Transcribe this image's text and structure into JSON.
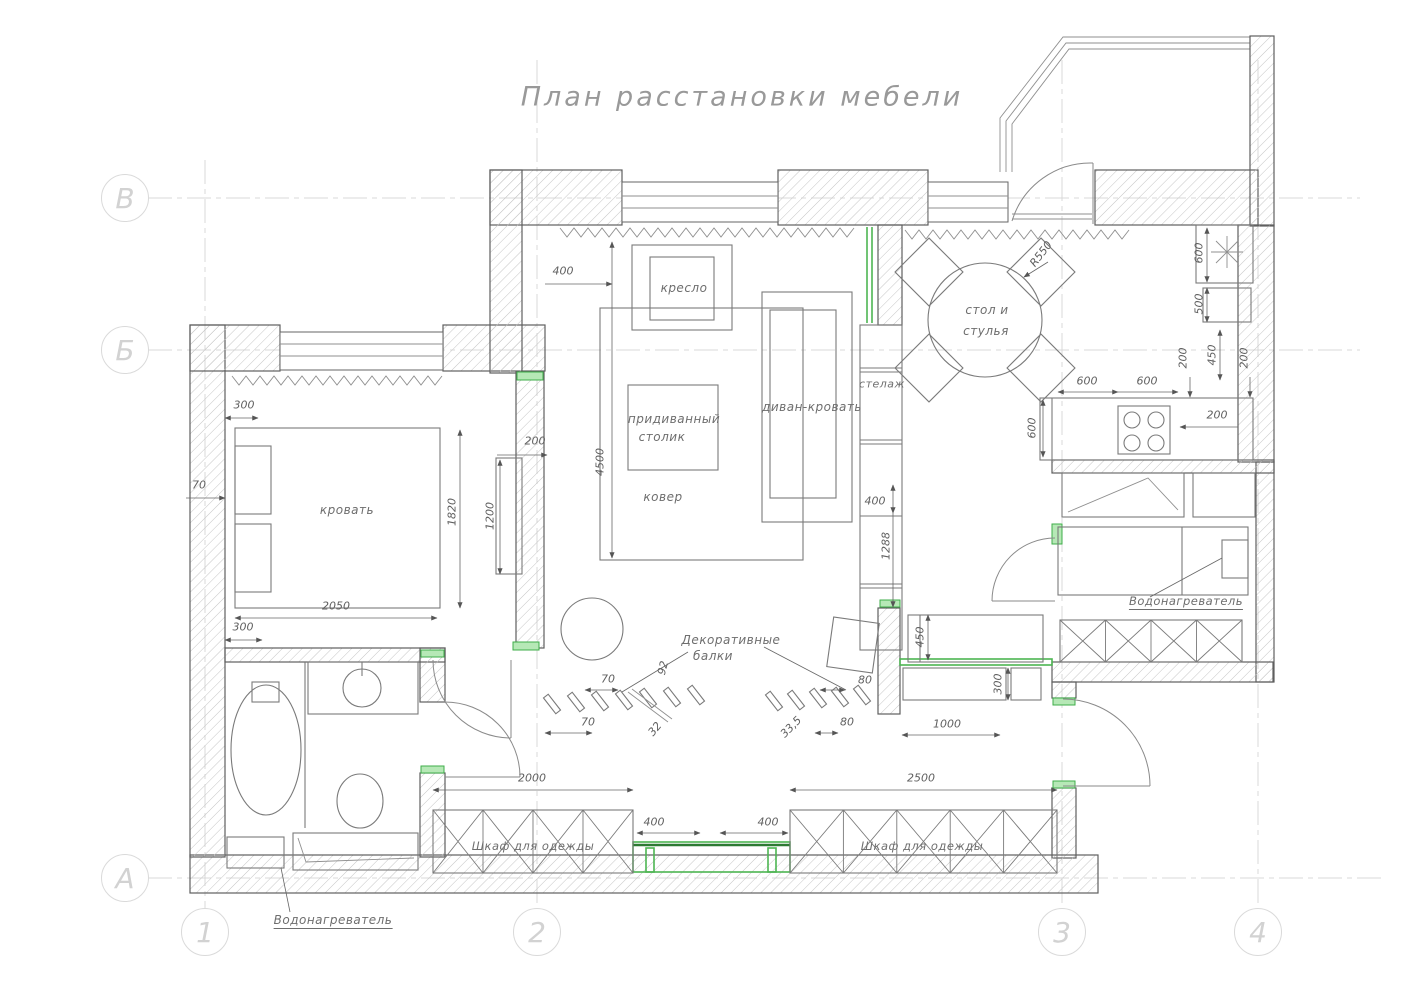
{
  "title": {
    "text": "План расстановки мебели"
  },
  "colors": {
    "accent_green": "#4db552",
    "line": "#6a6a6a",
    "grid": "#d9d9d9",
    "hatch": "#c6c6c6"
  },
  "grid": {
    "rows": [
      {
        "name": "grid-bubble-v",
        "label": "В",
        "x": 125,
        "y": 198
      },
      {
        "name": "grid-bubble-b",
        "label": "Б",
        "x": 125,
        "y": 350
      },
      {
        "name": "grid-bubble-a",
        "label": "А",
        "x": 125,
        "y": 878
      }
    ],
    "cols": [
      {
        "name": "grid-bubble-1",
        "label": "1",
        "x": 205,
        "y": 932
      },
      {
        "name": "grid-bubble-2",
        "label": "2",
        "x": 537,
        "y": 932
      },
      {
        "name": "grid-bubble-3",
        "label": "3",
        "x": 1062,
        "y": 932
      },
      {
        "name": "grid-bubble-4",
        "label": "4",
        "x": 1258,
        "y": 932
      }
    ]
  },
  "labels": [
    {
      "name": "armchair-label",
      "text": "кресло",
      "x": 684,
      "y": 288
    },
    {
      "name": "sidetable-label-line1",
      "text": "придиванный",
      "x": 674,
      "y": 419
    },
    {
      "name": "sidetable-label-line2",
      "text": "столик",
      "x": 662,
      "y": 437
    },
    {
      "name": "sofa-label",
      "text": "диван-кровать",
      "x": 812,
      "y": 407
    },
    {
      "name": "shelf-label",
      "text": "стелаж",
      "x": 882,
      "y": 384,
      "s": 11
    },
    {
      "name": "carpet-label",
      "text": "ковер",
      "x": 663,
      "y": 497
    },
    {
      "name": "dining-label-line1",
      "text": "стол и",
      "x": 987,
      "y": 310
    },
    {
      "name": "dining-label-line2",
      "text": "стулья",
      "x": 986,
      "y": 331
    },
    {
      "name": "bed-label",
      "text": "кровать",
      "x": 347,
      "y": 510
    },
    {
      "name": "wardrobe-left-label",
      "text": "Шкаф для одежды",
      "x": 533,
      "y": 846,
      "s": 11.5
    },
    {
      "name": "wardrobe-right-label",
      "text": "Шкаф для одежды",
      "x": 922,
      "y": 846,
      "s": 11.5
    },
    {
      "name": "beams-label-line1",
      "text": "Декоративные",
      "x": 731,
      "y": 640
    },
    {
      "name": "beams-label-line2",
      "text": "балки",
      "x": 713,
      "y": 656
    },
    {
      "name": "waterheater-bottom-label",
      "text": "Водонагреватель",
      "x": 333,
      "y": 921,
      "cls": "underline"
    },
    {
      "name": "waterheater-right-label",
      "text": "Водонагреватель",
      "x": 1186,
      "y": 602,
      "s": 11.5,
      "cls": "underline"
    }
  ],
  "dimensions": [
    {
      "name": "dim-400-top",
      "text": "400",
      "x": 563,
      "y": 271
    },
    {
      "name": "dim-200-left",
      "text": "200",
      "x": 535,
      "y": 441
    },
    {
      "name": "dim-4500",
      "text": "4500",
      "x": 600,
      "y": 462,
      "r": -90
    },
    {
      "name": "dim-300-bed-top",
      "text": "300",
      "x": 244,
      "y": 405
    },
    {
      "name": "dim-70-left",
      "text": "70",
      "x": 199,
      "y": 485
    },
    {
      "name": "dim-1820",
      "text": "1820",
      "x": 452,
      "y": 512,
      "r": -90
    },
    {
      "name": "dim-1200",
      "text": "1200",
      "x": 490,
      "y": 516,
      "r": -90
    },
    {
      "name": "dim-2050",
      "text": "2050",
      "x": 336,
      "y": 606
    },
    {
      "name": "dim-300-bed-bottom",
      "text": "300",
      "x": 243,
      "y": 627
    },
    {
      "name": "dim-r550",
      "text": "R550",
      "x": 1041,
      "y": 254,
      "r": -52
    },
    {
      "name": "dim-600-dining-1",
      "text": "600",
      "x": 1087,
      "y": 381
    },
    {
      "name": "dim-600-dining-2",
      "text": "600",
      "x": 1147,
      "y": 381
    },
    {
      "name": "dim-600-counter",
      "text": "600",
      "x": 1032,
      "y": 428,
      "r": -90
    },
    {
      "name": "dim-200-kitchen-left",
      "text": "200",
      "x": 1183,
      "y": 358,
      "r": -90
    },
    {
      "name": "dim-450-kitchen",
      "text": "450",
      "x": 1212,
      "y": 355,
      "r": -90
    },
    {
      "name": "dim-200-kitchen-right",
      "text": "200",
      "x": 1244,
      "y": 358,
      "r": -90
    },
    {
      "name": "dim-600-column",
      "text": "600",
      "x": 1199,
      "y": 253,
      "r": -90
    },
    {
      "name": "dim-500-column",
      "text": "500",
      "x": 1199,
      "y": 304,
      "r": -90
    },
    {
      "name": "dim-200-stove",
      "text": "200",
      "x": 1217,
      "y": 415
    },
    {
      "name": "dim-400-shelf",
      "text": "400",
      "x": 875,
      "y": 501
    },
    {
      "name": "dim-1288",
      "text": "1288",
      "x": 886,
      "y": 546,
      "r": -90
    },
    {
      "name": "dim-450-bench",
      "text": "450",
      "x": 920,
      "y": 637,
      "r": -90
    },
    {
      "name": "dim-300-shoe",
      "text": "300",
      "x": 998,
      "y": 684,
      "r": -90
    },
    {
      "name": "dim-1000",
      "text": "1000",
      "x": 947,
      "y": 724
    },
    {
      "name": "dim-70-beams-1",
      "text": "70",
      "x": 608,
      "y": 679
    },
    {
      "name": "dim-70-beams-2",
      "text": "70",
      "x": 588,
      "y": 722
    },
    {
      "name": "dim-92",
      "text": "92",
      "x": 663,
      "y": 668,
      "r": -75
    },
    {
      "name": "dim-32",
      "text": "32",
      "x": 655,
      "y": 729,
      "r": -50
    },
    {
      "name": "dim-80-beams-1",
      "text": "80",
      "x": 865,
      "y": 680
    },
    {
      "name": "dim-80-beams-2",
      "text": "80",
      "x": 847,
      "y": 722
    },
    {
      "name": "dim-33-5",
      "text": "33,5",
      "x": 791,
      "y": 727,
      "r": -45
    },
    {
      "name": "dim-2000",
      "text": "2000",
      "x": 532,
      "y": 778
    },
    {
      "name": "dim-400-bench-left",
      "text": "400",
      "x": 654,
      "y": 822
    },
    {
      "name": "dim-400-bench-right",
      "text": "400",
      "x": 768,
      "y": 822
    },
    {
      "name": "dim-2500",
      "text": "2500",
      "x": 921,
      "y": 778
    }
  ]
}
